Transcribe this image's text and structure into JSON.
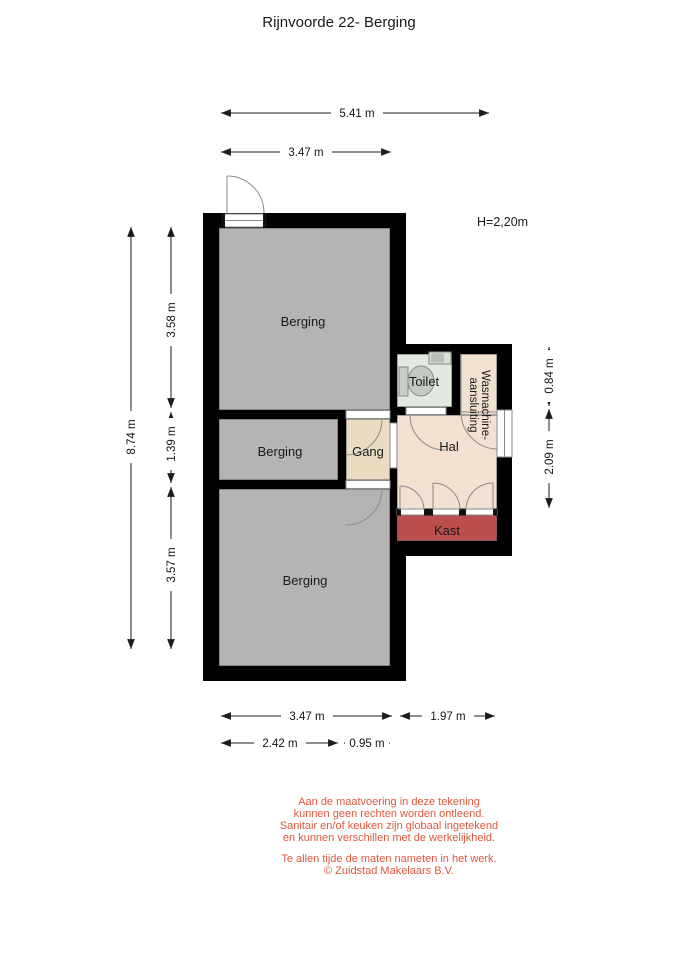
{
  "title": "Rijnvoorde 22- Berging",
  "height_label": "H=2,20m",
  "rooms": {
    "berging_top": "Berging",
    "berging_mid": "Berging",
    "berging_bottom": "Berging",
    "gang": "Gang",
    "toilet": "Toilet",
    "hal": "Hal",
    "kast": "Kast",
    "wasmachine_line1": "Wasmachine-",
    "wasmachine_line2": "aansluiting"
  },
  "dimensions": {
    "top_width_outer": "5.41 m",
    "top_width_inner": "3.47 m",
    "left_height_total": "8.74 m",
    "left_height_top": "3.58 m",
    "left_height_mid": "1.39 m",
    "left_height_bottom": "3.57 m",
    "right_height_top": "0.84 m",
    "right_height_mid": "2.09 m",
    "bottom_width_left": "3.47 m",
    "bottom_width_right": "1.97 m",
    "bottom_width_left_inner": "2.42 m",
    "bottom_width_right_inner": "0.95 m"
  },
  "disclaimer": {
    "lines": [
      "Aan de maatvoering in deze tekening",
      "kunnen geen rechten worden ontleend.",
      "Sanitair en/of keuken zijn globaal ingetekend",
      "en kunnen verschillen met de werkelijkheid."
    ],
    "lines2": [
      "Te allen tijde de maten nameten in het werk.",
      "© Zuidstad Makelaars B.V."
    ]
  },
  "colors": {
    "wall": "#010101",
    "berging": "#b4b4b4",
    "gang": "#e9dcc1",
    "hal": "#f2e1d1",
    "toilet": "#e3e8e0",
    "kast": "#ba4f4e",
    "disclaimer_text": "#e0573d"
  }
}
